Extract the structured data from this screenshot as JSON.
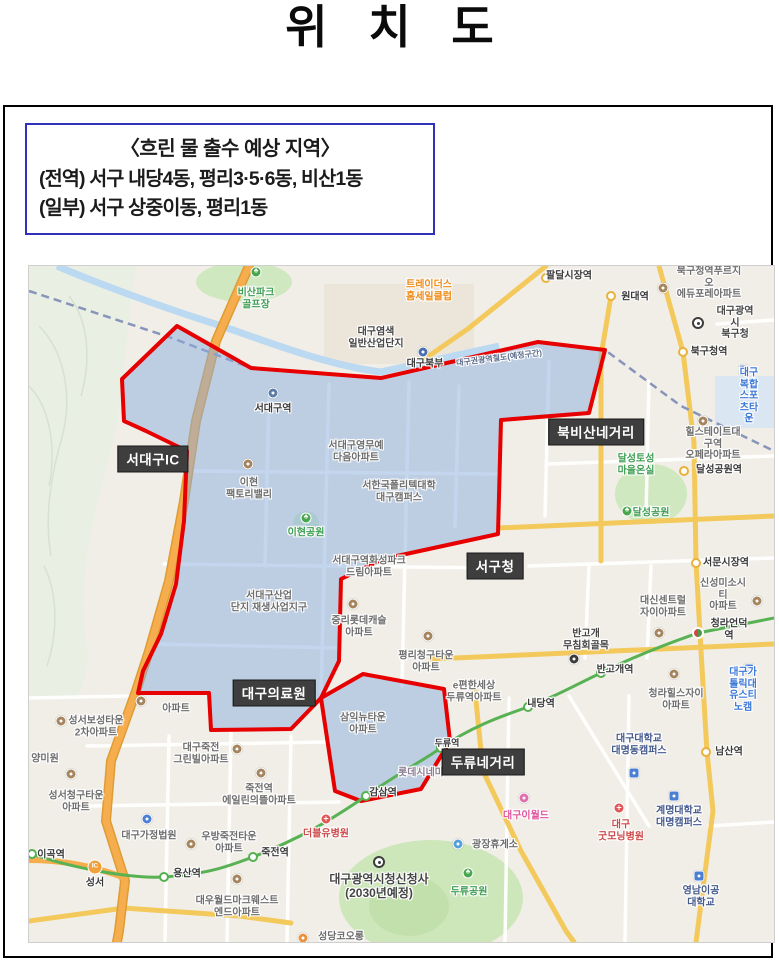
{
  "page": {
    "title": "위 치 도"
  },
  "info_box": {
    "heading": "〈흐린 물 출수 예상 지역〉",
    "line1": "(전역) 서구 내당4동, 평리3·5·6동, 비산1동",
    "line2": "(일부) 서구 상중이동, 평리1동",
    "border_color": "#3030b8"
  },
  "map": {
    "region_fill": "#8aaee0",
    "boundary_color": "#e60000",
    "badges": [
      {
        "t": "서대구IC",
        "x": 124,
        "y": 193
      },
      {
        "t": "북비산네거리",
        "x": 567,
        "y": 166
      },
      {
        "t": "서구청",
        "x": 466,
        "y": 300
      },
      {
        "t": "대구의료원",
        "x": 245,
        "y": 427
      },
      {
        "t": "두류네거리",
        "x": 454,
        "y": 496
      }
    ],
    "labels": [
      {
        "t": "비산파크\n골프장",
        "x": 227,
        "y": 33,
        "c": "green"
      },
      {
        "t": "대구염색\n일반산업단지",
        "x": 347,
        "y": 72,
        "c": "dark"
      },
      {
        "t": "서대구역",
        "x": 244,
        "y": 143,
        "c": "stn"
      },
      {
        "t": "서대구영무예\n다음아파트",
        "x": 327,
        "y": 186
      },
      {
        "t": "이현\n팩토리밸리",
        "x": 220,
        "y": 223
      },
      {
        "t": "서한국폴리텍대학\n대구캠퍼스",
        "x": 370,
        "y": 226
      },
      {
        "t": "이현공원",
        "x": 277,
        "y": 267,
        "c": "green"
      },
      {
        "t": "서대구역화성파크\n드림아파트",
        "x": 340,
        "y": 301
      },
      {
        "t": "서대구산업\n단지 재생사업지구",
        "x": 240,
        "y": 336
      },
      {
        "t": "중리롯데캐슬\n아파트",
        "x": 330,
        "y": 361
      },
      {
        "t": "평리청구타운\n아파트",
        "x": 397,
        "y": 396
      },
      {
        "t": "e편한세상\n두류역아파트",
        "x": 445,
        "y": 426
      },
      {
        "t": "삼익뉴타운\n아파트",
        "x": 334,
        "y": 458
      },
      {
        "t": "성서보성타운\n2차아파트",
        "x": 67,
        "y": 461
      },
      {
        "t": "아파트",
        "x": 147,
        "y": 443
      },
      {
        "t": "양미원",
        "x": 16,
        "y": 493
      },
      {
        "t": "성서청구타운\n아파트",
        "x": 47,
        "y": 536
      },
      {
        "t": "대구가정법원",
        "x": 120,
        "y": 570
      },
      {
        "t": "대구죽전\n그린빌아파트",
        "x": 172,
        "y": 488
      },
      {
        "t": "죽전역\n에일린의뜰아파트",
        "x": 230,
        "y": 529
      },
      {
        "t": "우방죽전타운\n아파트",
        "x": 200,
        "y": 577
      },
      {
        "t": "더블유병원",
        "x": 297,
        "y": 568,
        "c": "red"
      },
      {
        "t": "죽전역",
        "x": 246,
        "y": 587,
        "c": "stn"
      },
      {
        "t": "용산역",
        "x": 158,
        "y": 608,
        "c": "stn"
      },
      {
        "t": "이곡역",
        "x": 22,
        "y": 589,
        "c": "stn"
      },
      {
        "t": "성서",
        "x": 66,
        "y": 617,
        "c": "stn"
      },
      {
        "t": "대우월드마크웨스트\n엔드아파트",
        "x": 208,
        "y": 641
      },
      {
        "t": "대구광역시청신청사\n(2030년예정)",
        "x": 350,
        "y": 621,
        "c": "dark",
        "s": 12
      },
      {
        "t": "성당코오롱",
        "x": 312,
        "y": 671
      },
      {
        "t": "두류공원",
        "x": 440,
        "y": 626,
        "c": "green"
      },
      {
        "t": "광장휴게소",
        "x": 466,
        "y": 579
      },
      {
        "t": "대구이월드",
        "x": 497,
        "y": 550,
        "c": "pink"
      },
      {
        "t": "롯데시네마",
        "x": 392,
        "y": 507,
        "c": "purple"
      },
      {
        "t": "감삼역",
        "x": 354,
        "y": 527,
        "c": "stn"
      },
      {
        "t": "두류역",
        "x": 418,
        "y": 477,
        "c": "stn",
        "s": 9
      },
      {
        "t": "내당역",
        "x": 512,
        "y": 438,
        "c": "stn"
      },
      {
        "t": "반고개역",
        "x": 586,
        "y": 404,
        "c": "stn"
      },
      {
        "t": "청라언덕역",
        "x": 700,
        "y": 364,
        "c": "stn"
      },
      {
        "t": "반고개\n무침회골목",
        "x": 557,
        "y": 374,
        "c": "dark"
      },
      {
        "t": "대신센트럴\n자이아파트",
        "x": 634,
        "y": 341
      },
      {
        "t": "신성미소시티\n아파트",
        "x": 694,
        "y": 329
      },
      {
        "t": "서문시장역",
        "x": 697,
        "y": 297,
        "c": "stn"
      },
      {
        "t": "달성공원",
        "x": 622,
        "y": 247,
        "c": "green"
      },
      {
        "t": "달성토성\n마을온실",
        "x": 607,
        "y": 199,
        "c": "green"
      },
      {
        "t": "달성공원역",
        "x": 690,
        "y": 204,
        "c": "stn"
      },
      {
        "t": "힐스테이트대구역\n오페라아파트",
        "x": 684,
        "y": 178
      },
      {
        "t": "대구복합\n스포츠타운",
        "x": 720,
        "y": 130,
        "c": "blue"
      },
      {
        "t": "북구청역",
        "x": 680,
        "y": 86,
        "c": "stn"
      },
      {
        "t": "대구광역시\n북구청",
        "x": 706,
        "y": 57,
        "c": "dark"
      },
      {
        "t": "북구청역푸르지오\n에듀포레아파트",
        "x": 680,
        "y": 17
      },
      {
        "t": "원대역",
        "x": 606,
        "y": 31,
        "c": "stn"
      },
      {
        "t": "팔달시장역",
        "x": 540,
        "y": 10,
        "c": "stn"
      },
      {
        "t": "트레이더스\n홈세일클럽",
        "x": 400,
        "y": 25,
        "c": "orange"
      },
      {
        "t": "대구북부",
        "x": 396,
        "y": 98,
        "c": "stn"
      },
      {
        "t": "대구권광역철도(예정구간)",
        "x": 470,
        "y": 92,
        "c": "rail",
        "s": 8,
        "rot": -7
      },
      {
        "t": "대구대학교\n대명동캠퍼스",
        "x": 610,
        "y": 479,
        "c": "navy"
      },
      {
        "t": "남산역",
        "x": 700,
        "y": 486,
        "c": "stn"
      },
      {
        "t": "계명대학교\n대명캠퍼스",
        "x": 650,
        "y": 551,
        "c": "navy"
      },
      {
        "t": "대구\n굿모닝병원",
        "x": 592,
        "y": 565,
        "c": "red"
      },
      {
        "t": "영남이공\n대학교",
        "x": 672,
        "y": 631,
        "c": "navy"
      },
      {
        "t": "청라힐스자이\n아파트",
        "x": 647,
        "y": 434
      },
      {
        "t": "대구가톨릭대\n유스티노캠",
        "x": 714,
        "y": 424,
        "c": "blue"
      }
    ],
    "icons": [
      {
        "k": "tree",
        "x": 227,
        "y": 6
      },
      {
        "k": "poi",
        "c": "#5a7ca8",
        "x": 244,
        "y": 127
      },
      {
        "k": "poi",
        "x": 219,
        "y": 198
      },
      {
        "k": "tree",
        "x": 277,
        "y": 252
      },
      {
        "k": "poi",
        "x": 324,
        "y": 338
      },
      {
        "k": "poi",
        "x": 399,
        "y": 370
      },
      {
        "k": "poi",
        "x": 112,
        "y": 435
      },
      {
        "k": "poi",
        "x": 32,
        "y": 455
      },
      {
        "k": "poi",
        "x": 42,
        "y": 508
      },
      {
        "k": "poi",
        "c": "#4a7fd4",
        "x": 118,
        "y": 553
      },
      {
        "k": "poi",
        "x": 208,
        "y": 483
      },
      {
        "k": "poi",
        "x": 232,
        "y": 507
      },
      {
        "k": "poi",
        "x": 162,
        "y": 578
      },
      {
        "k": "cross",
        "x": 297,
        "y": 553
      },
      {
        "k": "poi",
        "x": 208,
        "y": 613
      },
      {
        "k": "gov",
        "x": 350,
        "y": 596
      },
      {
        "k": "poi",
        "c": "#e8913f",
        "x": 274,
        "y": 672
      },
      {
        "k": "tree",
        "x": 439,
        "y": 607
      },
      {
        "k": "poi",
        "c": "#55a0d8",
        "x": 429,
        "y": 578
      },
      {
        "k": "poi",
        "c": "#e06fae",
        "x": 495,
        "y": 532
      },
      {
        "k": "st-g",
        "x": 3,
        "y": 588
      },
      {
        "k": "st-g",
        "x": 135,
        "y": 611
      },
      {
        "k": "st-g",
        "x": 224,
        "y": 591
      },
      {
        "k": "st-g",
        "x": 337,
        "y": 530
      },
      {
        "k": "st-g",
        "x": 412,
        "y": 482
      },
      {
        "k": "st-g",
        "x": 499,
        "y": 441
      },
      {
        "k": "st-g",
        "x": 572,
        "y": 407
      },
      {
        "k": "st-t",
        "x": 669,
        "y": 367
      },
      {
        "k": "ic",
        "x": 66,
        "y": 601
      },
      {
        "k": "poi",
        "c": "#4a6fb0",
        "x": 394,
        "y": 86
      },
      {
        "k": "poi",
        "x": 634,
        "y": 22
      },
      {
        "k": "st-y",
        "x": 582,
        "y": 30
      },
      {
        "k": "st-y",
        "x": 517,
        "y": 12
      },
      {
        "k": "gov",
        "x": 669,
        "y": 57
      },
      {
        "k": "st-y",
        "x": 654,
        "y": 86
      },
      {
        "k": "sq",
        "x": 715,
        "y": 104
      },
      {
        "k": "poi",
        "x": 674,
        "y": 155
      },
      {
        "k": "st-y",
        "x": 655,
        "y": 205
      },
      {
        "k": "tree",
        "x": 598,
        "y": 245
      },
      {
        "k": "st-y",
        "x": 667,
        "y": 297
      },
      {
        "k": "poi",
        "x": 630,
        "y": 367
      },
      {
        "k": "poi",
        "x": 728,
        "y": 335
      },
      {
        "k": "poi",
        "c": "#3b3b3b",
        "x": 545,
        "y": 393
      },
      {
        "k": "poi",
        "x": 645,
        "y": 408
      },
      {
        "k": "sq",
        "x": 720,
        "y": 403
      },
      {
        "k": "sq",
        "x": 605,
        "y": 507
      },
      {
        "k": "st-y",
        "x": 677,
        "y": 486
      },
      {
        "k": "sq",
        "x": 645,
        "y": 530
      },
      {
        "k": "cross",
        "x": 590,
        "y": 542
      },
      {
        "k": "sq",
        "x": 670,
        "y": 610
      }
    ]
  }
}
